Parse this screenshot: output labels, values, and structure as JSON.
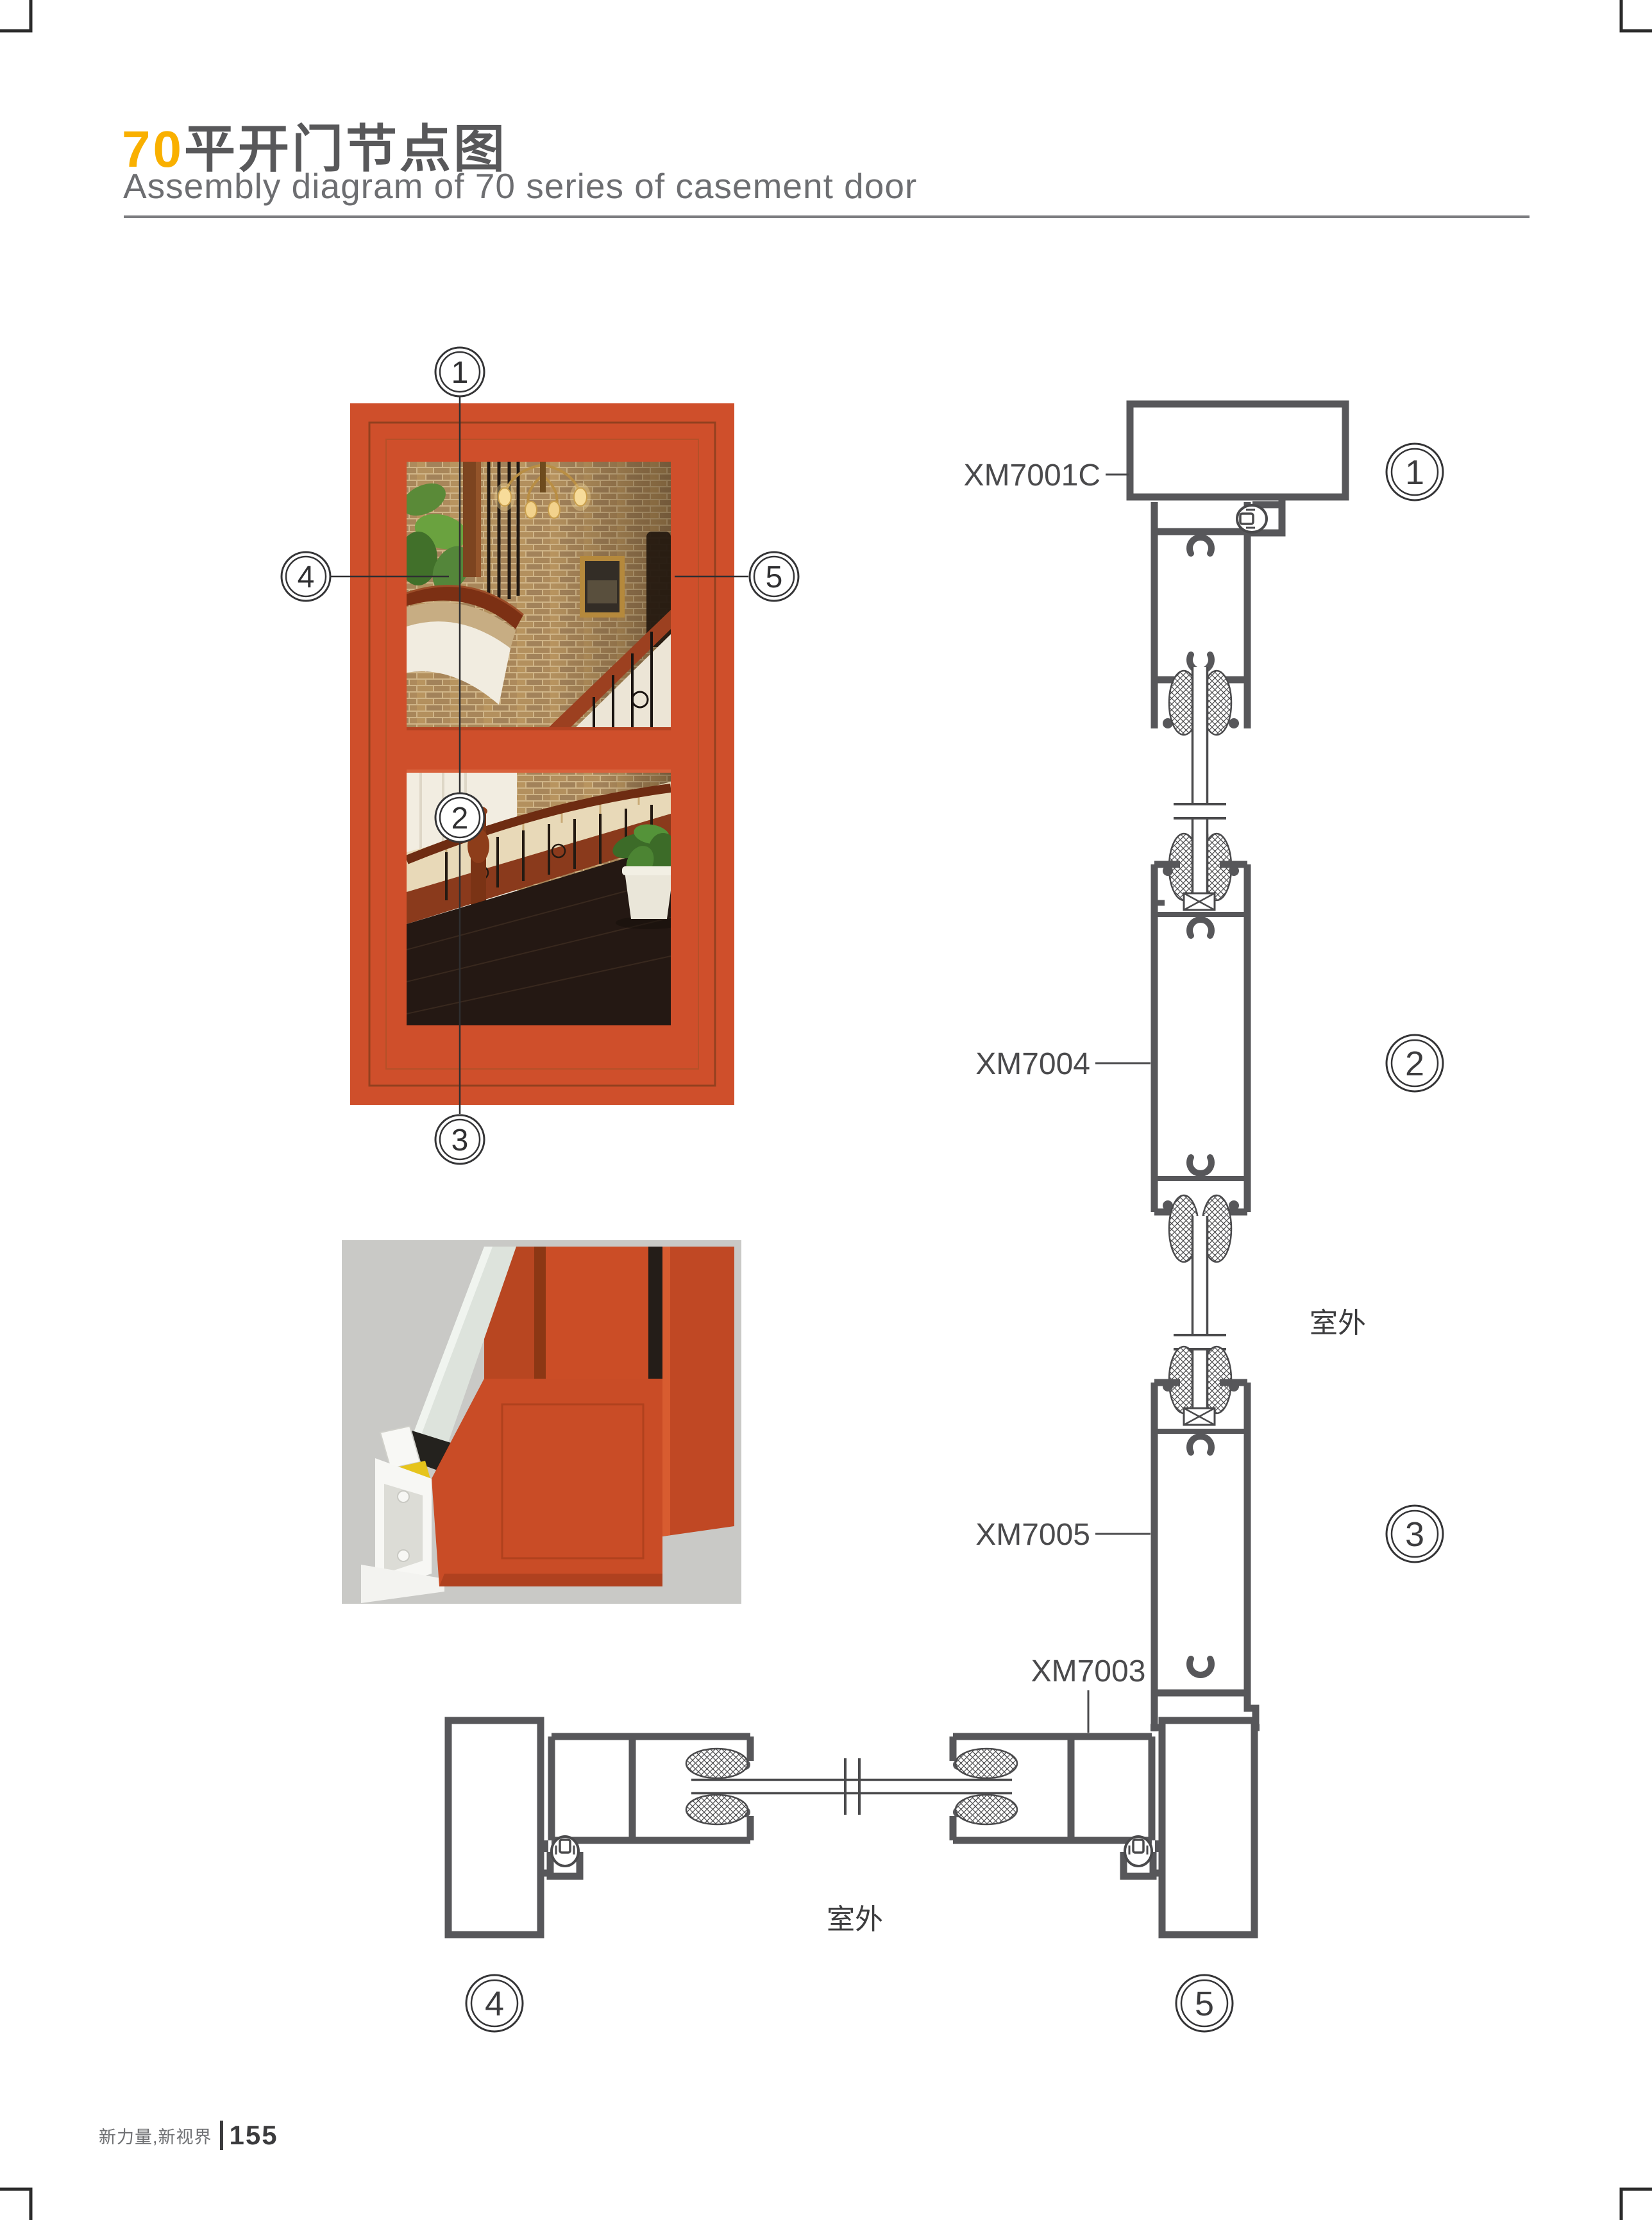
{
  "header": {
    "title_num": "70",
    "title_cn": "平开门节点图",
    "subtitle": "Assembly diagram of 70 series of casement door"
  },
  "labels": {
    "s1": "XM7001C",
    "s2": "XM7004",
    "s3": "XM7005",
    "s4": "XM7003",
    "outdoor_right": "室外",
    "outdoor_bottom": "室外"
  },
  "callouts": {
    "n1": "1",
    "n2": "2",
    "n3": "3",
    "n4": "4",
    "n5": "5"
  },
  "footer": {
    "slogan": "新力量,新视界",
    "page_number": "155"
  },
  "colors": {
    "accent": "#f9b000",
    "title_gray": "#58585a",
    "subtitle_gray": "#6d6e71",
    "drawing_line": "#57575a",
    "frame_orange": "#cf4f2b",
    "render_background": "#c9c9c6"
  }
}
